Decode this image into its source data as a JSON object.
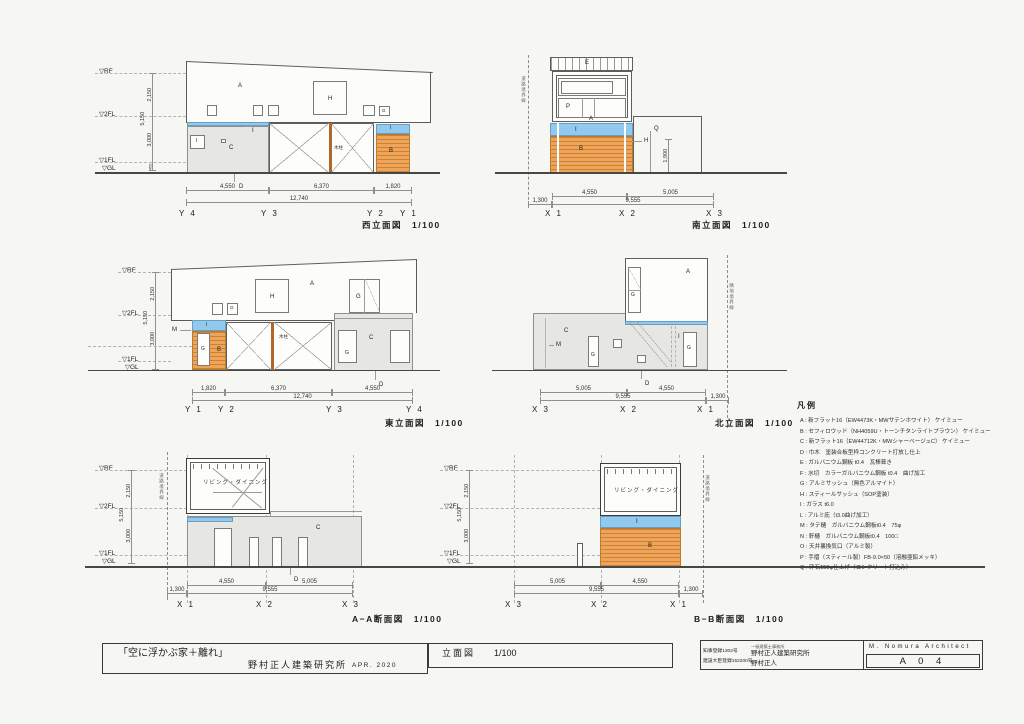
{
  "sheet": {
    "levels": {
      "rf": "▽RF",
      "f2": "▽2FL",
      "f1": "▽1FL",
      "gl": "▽GL"
    },
    "vdims": {
      "upper": "2,150",
      "total": "5,150",
      "lower": "3,000",
      "gl": "450"
    },
    "tags": {
      "A": "A",
      "B": "B",
      "C": "C",
      "D": "D",
      "E": "E",
      "G": "G",
      "H": "H",
      "I": "I",
      "M": "M",
      "P": "P",
      "Q": "Q"
    },
    "notes": {
      "wood_post": "木柱",
      "living": "リビング・ダイニング",
      "road": "道路境界線",
      "adjacent": "隣地境界線"
    }
  },
  "west": {
    "caption": "西立面図　1/100",
    "dims": {
      "d1": "4,550",
      "d2": "6,370",
      "d3": "1,820",
      "total": "12,740"
    },
    "grids": [
      "Y 4",
      "Y 3",
      "Y 2",
      "Y 1"
    ]
  },
  "south": {
    "caption": "南立面図　1/100",
    "dims": {
      "left": "1,300",
      "d1": "4,550",
      "d2": "5,005",
      "total": "9,555",
      "height": "1,900"
    },
    "grids": [
      "X 1",
      "X 2",
      "X 3"
    ]
  },
  "east": {
    "caption": "東立面図　1/100",
    "dims": {
      "d1": "1,820",
      "d2": "6,370",
      "d3": "4,550",
      "total": "12,740"
    },
    "grids": [
      "Y 1",
      "Y 2",
      "Y 3",
      "Y 4"
    ]
  },
  "north": {
    "caption": "北立面図　1/100",
    "dims": {
      "d1": "5,005",
      "d2": "4,550",
      "total": "9,555",
      "right": "1,300"
    },
    "grids": [
      "X 3",
      "X 2",
      "X 1"
    ]
  },
  "aa": {
    "caption": "A−A断面図　1/100",
    "dims": {
      "left": "1,300",
      "d1": "4,550",
      "d2": "5,005",
      "total": "9,555"
    },
    "grids": [
      "X 1",
      "X 2",
      "X 3"
    ]
  },
  "bb": {
    "caption": "B−B断面図　1/100",
    "dims": {
      "d1": "5,005",
      "d2": "4,550",
      "total": "9,555",
      "right": "1,300"
    },
    "grids": [
      "X 3",
      "X 2",
      "X 1"
    ]
  },
  "legend": {
    "title": "凡例",
    "lines": [
      "A : 新フラット16（EW4473K・MWサテンホワイト） ケイミュー",
      "B : セフィロウッド（NH4059U・トーンチタンライトブラウン） ケイミュー",
      "C : 新フラット16（EW44712K・MWシャーベージュC） ケイミュー",
      "D : 巾木　塗装合板型枠コンクリート打放し仕上",
      "E : ガルバニウム鋼板 t0.4　瓦棒葺き",
      "F : 水切　カラーガルバニウム鋼板 t0.4　曲げ加工",
      "G : アルミサッシュ（無色アルマイト）",
      "H : スティールサッシュ（SOP塗装）",
      "I : ガラス t6.0",
      "L : アルミ庇（t3.0曲げ加工）",
      "M : タテ樋　ガルバニウム鋼板t0.4　75φ",
      "N : 軒樋　ガルバニウム鋼板t0.4　100□",
      "O : 天井裏換気口（アルミ製）",
      "P : 手摺（スティール製）FB-9.0×50（溶融亜鉛メッキ）",
      "Q : 砕石150φ仕上げ（コンクリート打込み）"
    ]
  },
  "titleblock": {
    "project": "「空に浮かぶ家＋離れ」",
    "office": "野村正人建築研究所",
    "date": "APR. 2020",
    "drawing": "立面図",
    "scale": "1/100",
    "reg1": "知事登録1302号",
    "reg2": "建設大臣登録152200号",
    "office_type": "一級建築士事務所",
    "office2": "野村正人建築研究所",
    "architect": "野村正人",
    "architect_en": "M. Nomura Architect",
    "sheet_no": "A 0 4"
  }
}
